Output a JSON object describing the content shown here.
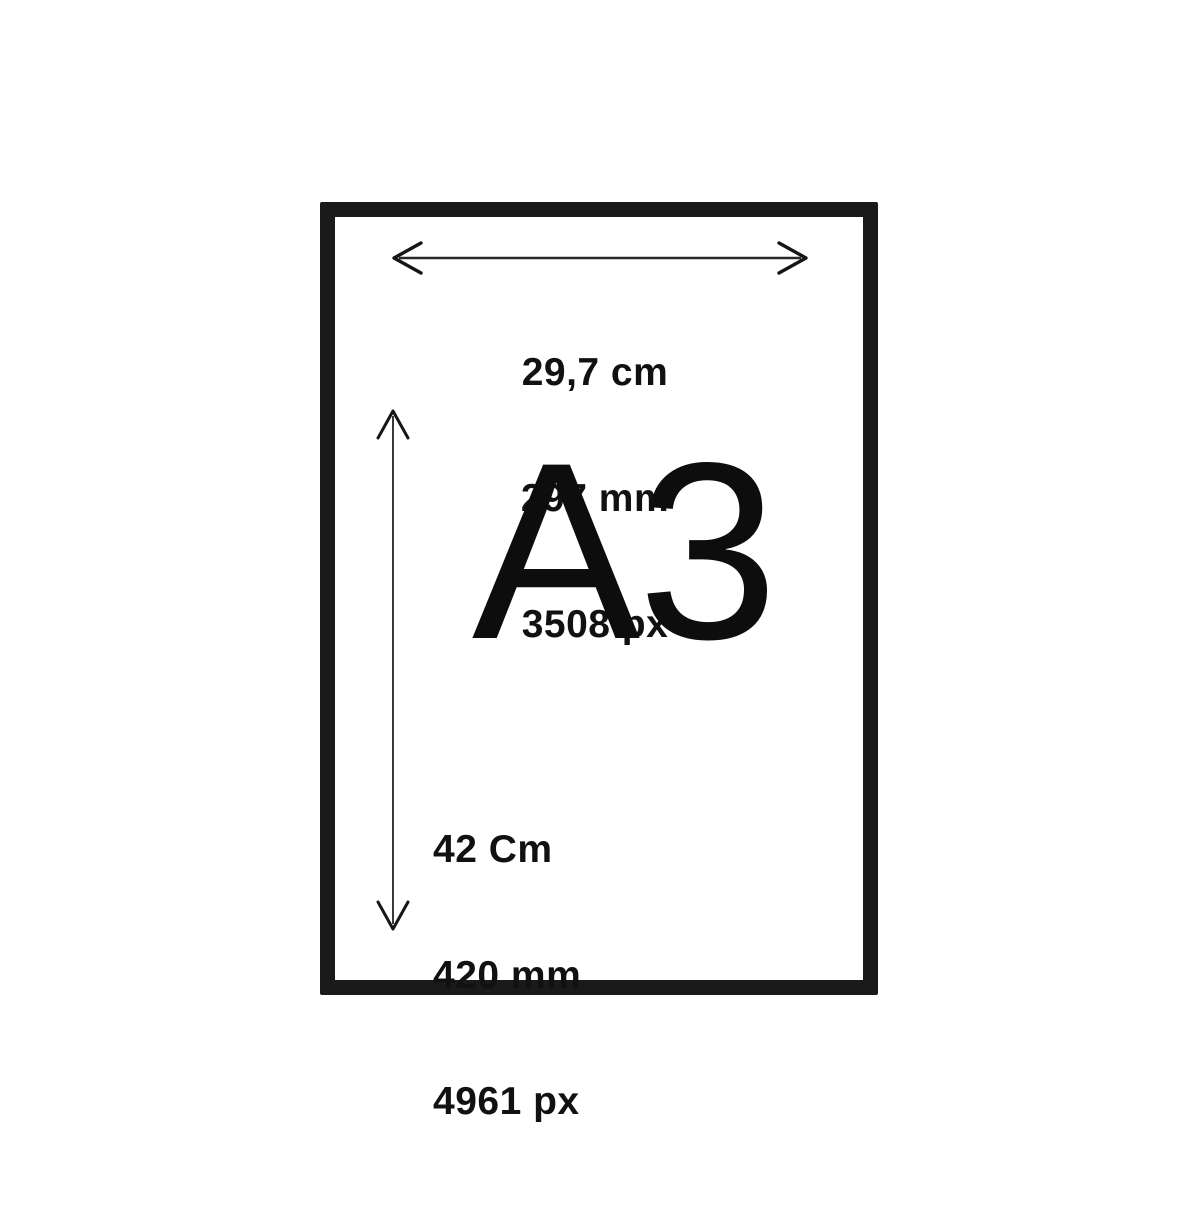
{
  "paper": {
    "size_label": "A3",
    "border_color": "#1a1a1a",
    "fill": "#ffffff"
  },
  "width_dimension": {
    "cm": "29,7 cm",
    "mm": "297 mm",
    "px": "3508 px"
  },
  "height_dimension": {
    "cm": "42 Cm",
    "mm": "420 mm",
    "px": "4961 px"
  },
  "icons": {
    "horizontal_arrow": "double-headed-horizontal-arrow",
    "vertical_arrow": "double-headed-vertical-arrow"
  },
  "colors": {
    "text": "#111111",
    "arrow_shaft": "#2a2a2a",
    "arrow_head": "#161616",
    "background": "#ffffff"
  }
}
